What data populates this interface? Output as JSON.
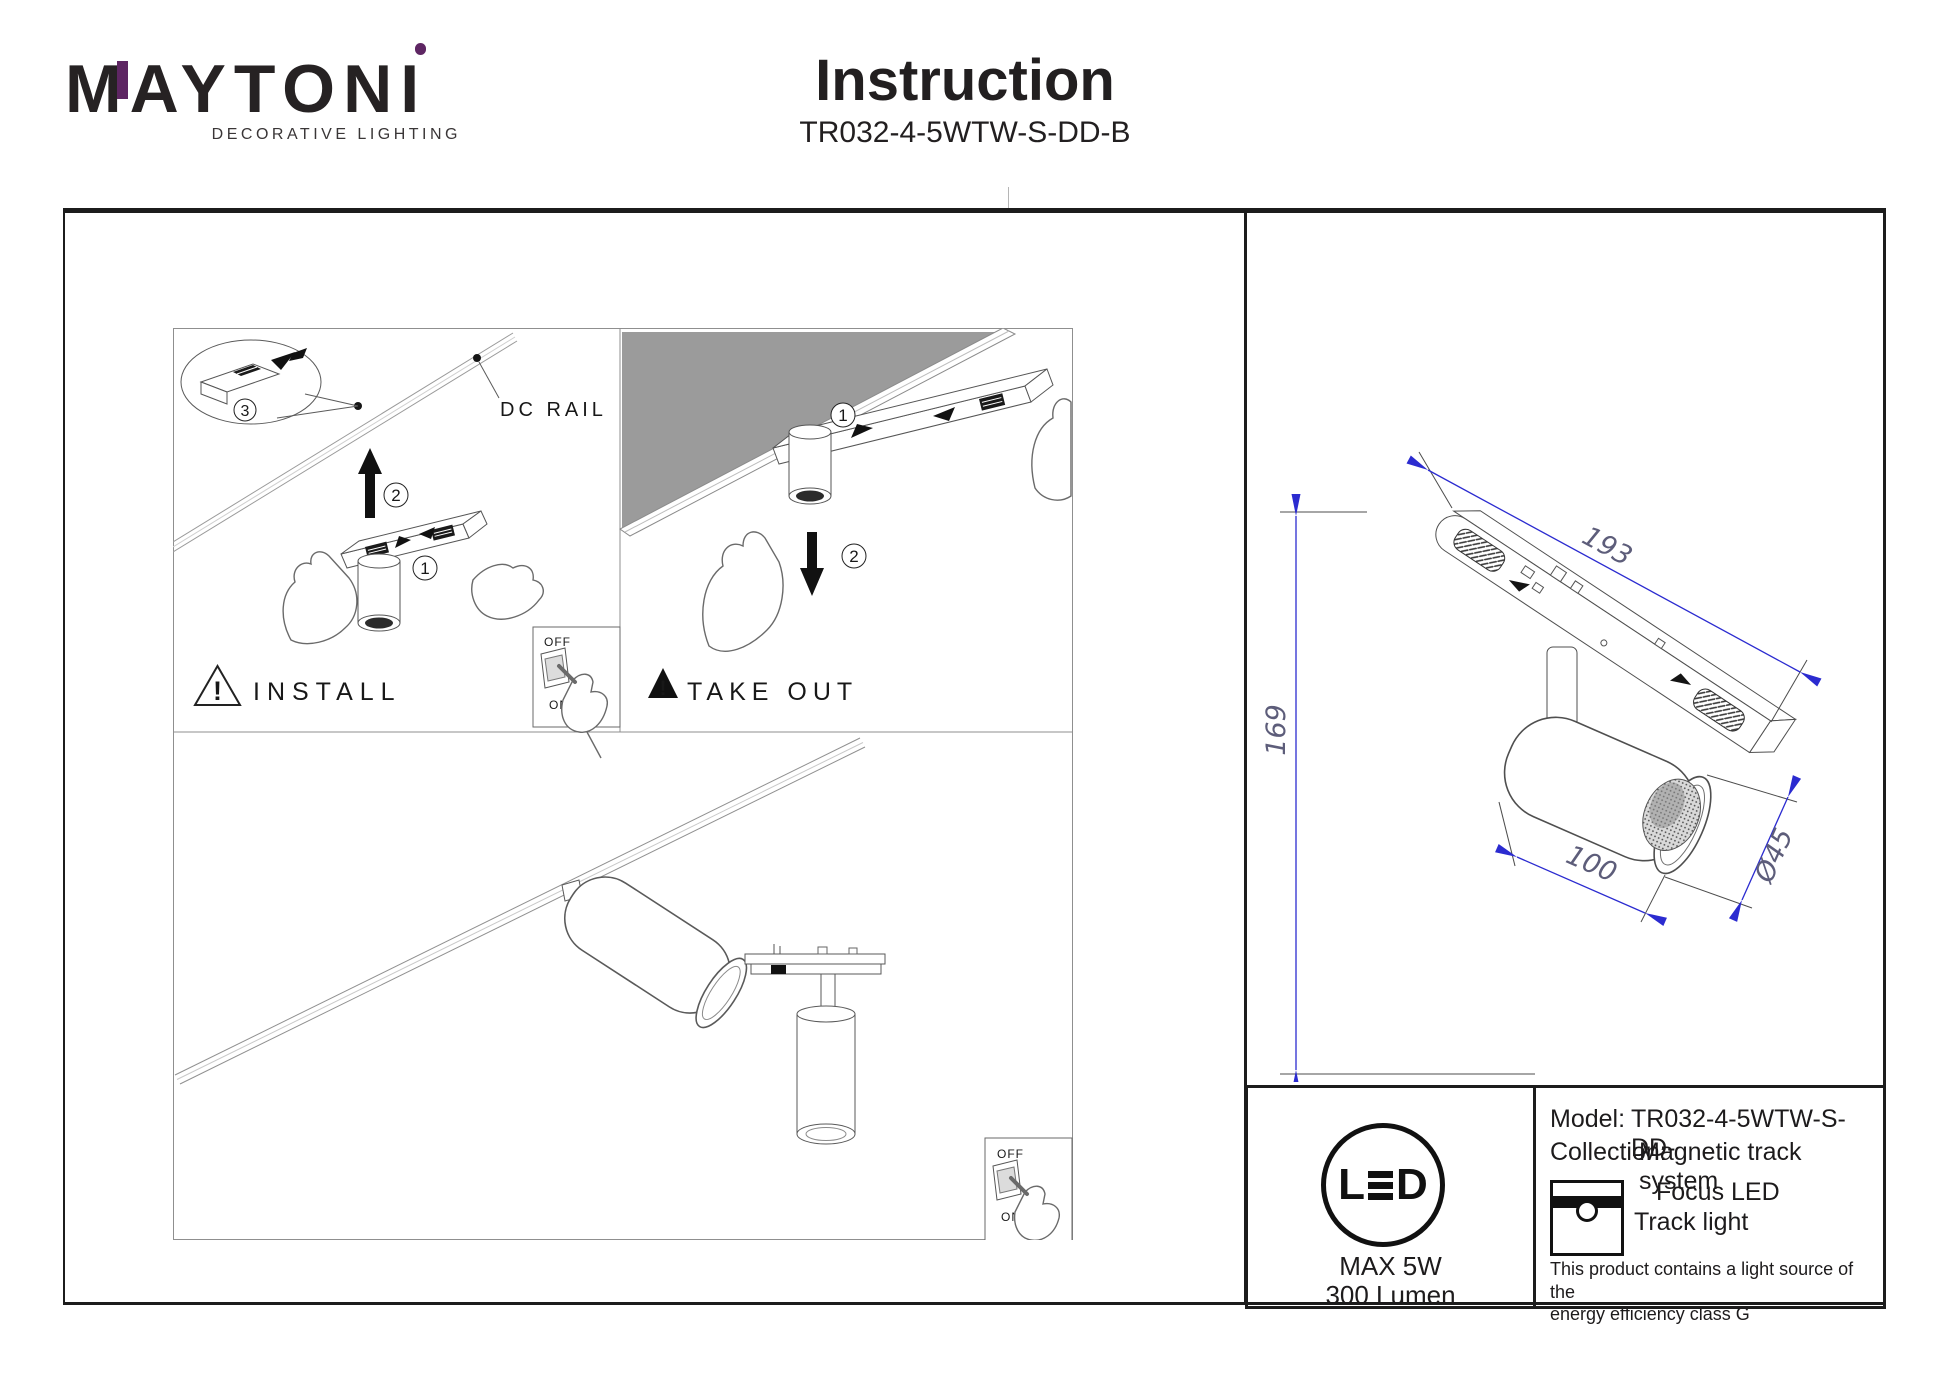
{
  "header": {
    "brand": "MAYTONI",
    "brand_m": "M",
    "brand_mid": "AYTON",
    "brand_i": "I",
    "tagline": "DECORATIVE LIGHTING",
    "title": "Instruction",
    "model_code": "TR032-4-5WTW-S-DD-B"
  },
  "diagram": {
    "dc_rail_label": "DC RAIL",
    "install_label": "INSTALL",
    "take_out_label": "TAKE OUT",
    "warning_mark": "!",
    "step_1": "1",
    "step_2": "2",
    "step_3": "3",
    "switch_off": "OFF",
    "switch_on": "ON"
  },
  "dimensions": {
    "track_length": "193",
    "total_height": "169",
    "body_length": "100",
    "diameter": "Ø45"
  },
  "spec": {
    "led_l": "L",
    "led_d": "D",
    "max_power": "MAX 5W",
    "lumen": "300 Lumen",
    "model_label": "Model:",
    "model_value": "TR032-4-5WTW-S-DD-",
    "collection_label": "Collection:",
    "collection_value": "Magnetic track system",
    "product_line1": "Focus LED",
    "product_line2": "Track light",
    "note_line1": "This product contains a light source of the",
    "note_line2": "energy efficiency class G"
  },
  "colors": {
    "accent_purple": "#5e2663",
    "dimension_blue": "#2b2bd0",
    "ceiling_gray": "#9b9b9b"
  }
}
